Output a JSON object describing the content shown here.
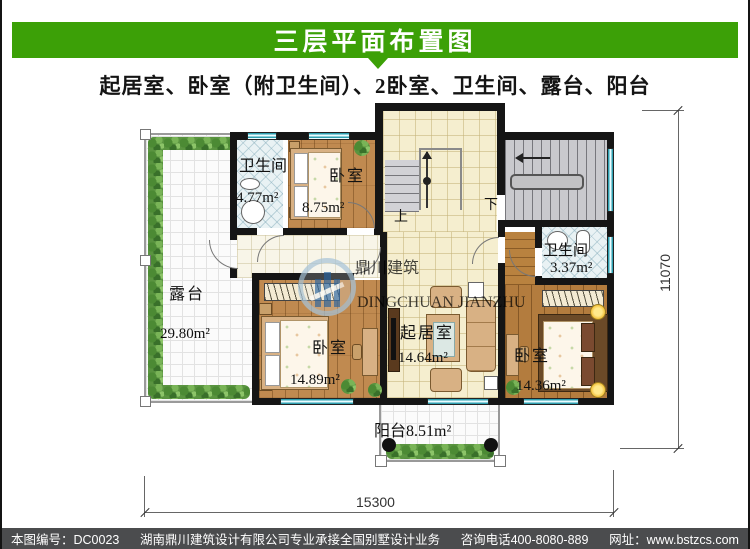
{
  "header": {
    "title": "三层平面布置图",
    "subtitle": "起居室、卧室（附卫生间）、2卧室、卫生间、露台、阳台"
  },
  "rooms": {
    "bath_top": {
      "name": "卫生间",
      "area": "4.77m²"
    },
    "bed_top": {
      "name": "卧室",
      "area": "8.75m²"
    },
    "terrace": {
      "name": "露台",
      "area": "29.80m²"
    },
    "bath_right": {
      "name": "卫生间",
      "area": "3.37m²"
    },
    "living": {
      "name": "起居室",
      "area": "14.64m²"
    },
    "bed_left": {
      "name": "卧室",
      "area": "14.89m²"
    },
    "bed_right": {
      "name": "卧室",
      "area": "14.36m²"
    },
    "balcony": {
      "name": "阳台",
      "area": "8.51m²"
    }
  },
  "stairs": {
    "up": "上",
    "down": "下"
  },
  "dimensions": {
    "width": "15300",
    "depth": "11070"
  },
  "watermark": {
    "cn": "鼎川建筑",
    "en": "DINGCHUAN JIANZHU"
  },
  "footer": {
    "number": "本图编号：DC0023",
    "company": "湖南鼎川建筑设计有限公司专业承接全国别墅设计业务",
    "phone": "咨询电话400-8080-889",
    "website": "网址：www.bstzcs.com"
  },
  "colors": {
    "banner": "#3CA007",
    "footer_bg": "#4B4C4E",
    "wall": "#151515"
  }
}
